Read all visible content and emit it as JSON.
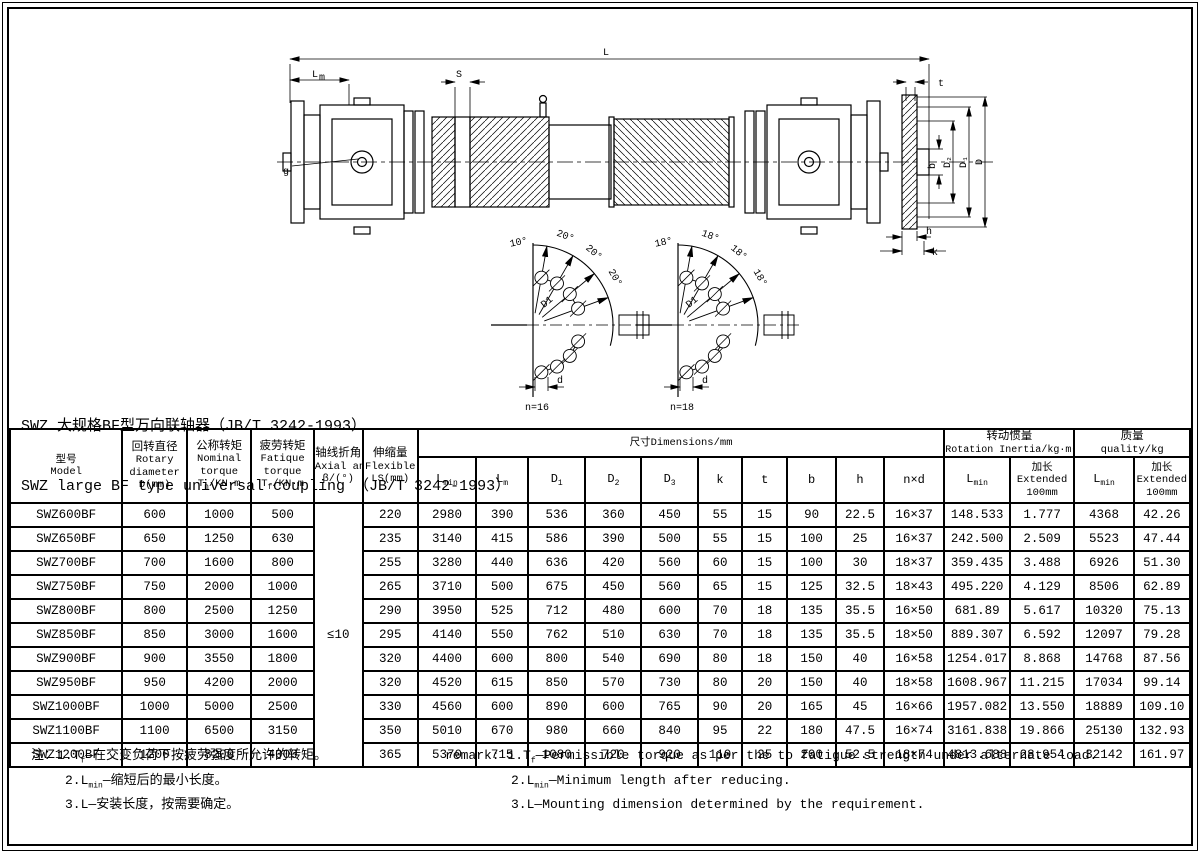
{
  "page": {
    "title_cn": "SWZ 大规格BF型万向联轴器（JB/T 3242-1993）",
    "title_en": "SWZ large BF type universal coupling （JB/T 3242-1993）"
  },
  "drawing": {
    "dims": {
      "L": "L",
      "Lm_base": "L",
      "Lm_sub": "m",
      "S": "S",
      "t": "t",
      "g": "g",
      "b": "b",
      "D2": "D₂",
      "D1": "D₁",
      "D": "D",
      "h": "h",
      "k": "k"
    },
    "bolt_diagrams": [
      {
        "caption": "n=16",
        "angles": [
          "10°",
          "20°",
          "20°",
          "20°"
        ],
        "radius_label": "D1",
        "hole_label": "d"
      },
      {
        "caption": "n=18",
        "angles": [
          "18°",
          "18°",
          "18°",
          "18°"
        ],
        "radius_label": "D1",
        "hole_label": "d"
      }
    ]
  },
  "table": {
    "headers": {
      "model": {
        "cn": "型号",
        "en": "Model"
      },
      "diameter": [
        "回转直径",
        "Rotary",
        "diameter",
        "D(mm)"
      ],
      "nominal": {
        "cn": "公称转矩",
        "en1": "Nominal",
        "en2": "torque",
        "f_base": "T",
        "f_sub": "n",
        "f_rest": "/KN·m"
      },
      "fatigue": {
        "cn": "疲劳转矩",
        "en1": "Fatique",
        "en2": "torque",
        "f_base": "T",
        "f_sub": "f",
        "f_rest": "/KN·m"
      },
      "axial": [
        "轴线折角",
        "Axial angle",
        "β/(°)"
      ],
      "flexible": [
        "伸缩量",
        "Flexible",
        "LS(mm)"
      ],
      "dims_group": "尺寸Dimensions/mm",
      "dims": [
        {
          "b": "L",
          "s": "min"
        },
        {
          "b": "L",
          "s": "m"
        },
        {
          "b": "D",
          "s": "1"
        },
        {
          "b": "D",
          "s": "2"
        },
        {
          "b": "D",
          "s": "3"
        },
        {
          "b": "k"
        },
        {
          "b": "t"
        },
        {
          "b": "b"
        },
        {
          "b": "h"
        },
        {
          "b": "n×d"
        }
      ],
      "inertia_group": {
        "cn": "转动惯量",
        "en": "Rotation Inertia/kg·m²"
      },
      "quality_group": {
        "cn": "质量",
        "en": "quality/kg"
      },
      "lmin": {
        "b": "L",
        "s": "min"
      },
      "extended": [
        "加长",
        "Extended",
        "100mm"
      ]
    },
    "rows": [
      [
        "SWZ600BF",
        "600",
        "1000",
        "500",
        "≤10",
        "220",
        "2980",
        "390",
        "536",
        "360",
        "450",
        "55",
        "15",
        "90",
        "22.5",
        "16×37",
        "148.533",
        "1.777",
        "4368",
        "42.26"
      ],
      [
        "SWZ650BF",
        "650",
        "1250",
        "630",
        "235",
        "3140",
        "415",
        "586",
        "390",
        "500",
        "55",
        "15",
        "100",
        "25",
        "16×37",
        "242.500",
        "2.509",
        "5523",
        "47.44"
      ],
      [
        "SWZ700BF",
        "700",
        "1600",
        "800",
        "255",
        "3280",
        "440",
        "636",
        "420",
        "560",
        "60",
        "15",
        "100",
        "30",
        "18×37",
        "359.435",
        "3.488",
        "6926",
        "51.30"
      ],
      [
        "SWZ750BF",
        "750",
        "2000",
        "1000",
        "265",
        "3710",
        "500",
        "675",
        "450",
        "560",
        "65",
        "15",
        "125",
        "32.5",
        "18×43",
        "495.220",
        "4.129",
        "8506",
        "62.89"
      ],
      [
        "SWZ800BF",
        "800",
        "2500",
        "1250",
        "290",
        "3950",
        "525",
        "712",
        "480",
        "600",
        "70",
        "18",
        "135",
        "35.5",
        "16×50",
        "681.89",
        "5.617",
        "10320",
        "75.13"
      ],
      [
        "SWZ850BF",
        "850",
        "3000",
        "1600",
        "295",
        "4140",
        "550",
        "762",
        "510",
        "630",
        "70",
        "18",
        "135",
        "35.5",
        "18×50",
        "889.307",
        "6.592",
        "12097",
        "79.28"
      ],
      [
        "SWZ900BF",
        "900",
        "3550",
        "1800",
        "320",
        "4400",
        "600",
        "800",
        "540",
        "690",
        "80",
        "18",
        "150",
        "40",
        "16×58",
        "1254.017",
        "8.868",
        "14768",
        "87.56"
      ],
      [
        "SWZ950BF",
        "950",
        "4200",
        "2000",
        "320",
        "4520",
        "615",
        "850",
        "570",
        "730",
        "80",
        "20",
        "150",
        "40",
        "18×58",
        "1608.967",
        "11.215",
        "17034",
        "99.14"
      ],
      [
        "SWZ1000BF",
        "1000",
        "5000",
        "2500",
        "330",
        "4560",
        "600",
        "890",
        "600",
        "765",
        "90",
        "20",
        "165",
        "45",
        "16×66",
        "1957.082",
        "13.550",
        "18889",
        "109.10"
      ],
      [
        "SWZ1100BF",
        "1100",
        "6500",
        "3150",
        "350",
        "5010",
        "670",
        "980",
        "660",
        "840",
        "95",
        "22",
        "180",
        "47.5",
        "16×74",
        "3161.838",
        "19.866",
        "25130",
        "132.93"
      ],
      [
        "SWZ1200BF",
        "1200",
        "8200",
        "4000",
        "365",
        "5370",
        "715",
        "1080",
        "720",
        "920",
        "110",
        "25",
        "200",
        "52.5",
        "18×74",
        "4813.688",
        "28.954",
        "32142",
        "161.97"
      ]
    ]
  },
  "notes": {
    "cn_label": "注：",
    "cn": [
      {
        "pre": "1.T",
        "sub": "f",
        "text": "—在交变负荷下按疲劳强度所允许的转矩。"
      },
      {
        "pre": "2.L",
        "sub": "min",
        "text": "—缩短后的最小长度。"
      },
      {
        "pre": "3.L",
        "sub": "",
        "text": "—安装长度，按需要确定。"
      }
    ],
    "en_label": "remark:",
    "en": [
      {
        "pre": "1.T",
        "sub": "f",
        "text": "—Permissible torque as per the to fatigue strength under alternate load."
      },
      {
        "pre": "2.L",
        "sub": "min",
        "text": "—Minimum length after reducing."
      },
      {
        "pre": "3.L",
        "sub": "",
        "text": "—Mounting dimension determined by the requirement."
      }
    ]
  }
}
